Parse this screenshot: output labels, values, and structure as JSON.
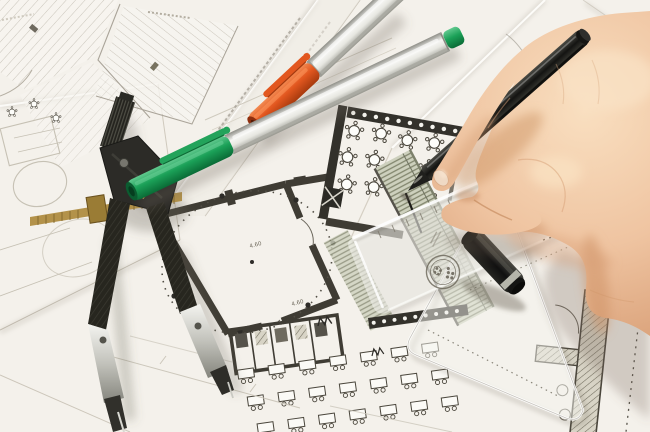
{
  "scene": {
    "subject": "Hand drawing with a black pen on architectural floor plans",
    "setting": "Overlapping blueprint sheets with drafting tools on a desk"
  },
  "annotations": {
    "dim_a": "4.60",
    "dim_b": "4.60"
  },
  "objects": {
    "compass": "drafting compass divider",
    "marker_orange": "silver marker with orange cap",
    "marker_green": "silver marker with green cap",
    "pen": "black fineliner pen held in right hand",
    "pen_cap": "black pen cap",
    "scale_ruler": "transparent scale ruler with stamp emblem",
    "set_square": "transparent set square triangle",
    "hand": "right hand drawing a line",
    "plans": "floor plans: round-table room, hall with dashed circle, desk rows, parking lot"
  },
  "colors": {
    "paper": "#efede7",
    "sheet_white": "#faf9f5",
    "plan_faint": "#b5afa3",
    "plan_wall": "#3f3c34",
    "hatch_line": "#7d816c",
    "ink": "#1c1b18",
    "compass_black": "#26251f",
    "steel": "#cfcfc9",
    "brass": "#b3924a",
    "marker_silver": "#d9d9d4",
    "marker_orange": "#e2571f",
    "marker_green": "#23a35b",
    "pen_black": "#1f1f1c",
    "cap_ring": "#b5b5aa",
    "skin": "#efc4a1",
    "skin_shadow": "#cf9468",
    "nail": "#efd9c4",
    "stamp": "#6a6558"
  }
}
